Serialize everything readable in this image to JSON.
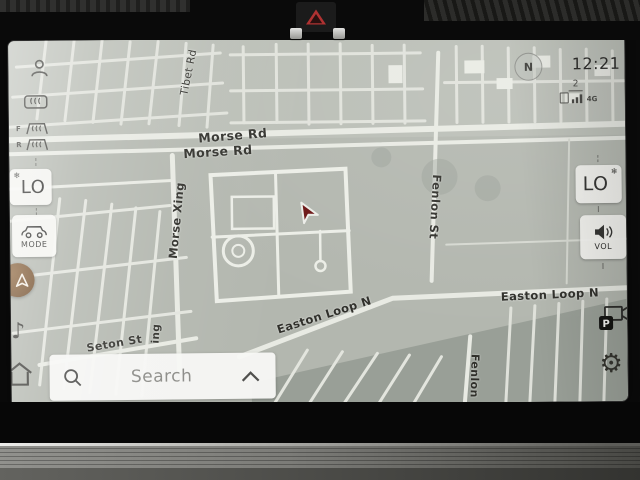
{
  "status": {
    "time": "12:21",
    "compass_n": "N",
    "profile": "2",
    "network": "4G"
  },
  "climate_left": {
    "lo": "LO",
    "defrost_front": "F",
    "defrost_rear": "R"
  },
  "climate_right": {
    "lo": "LO"
  },
  "mode": {
    "label": "MODE"
  },
  "volume": {
    "label": "VOL"
  },
  "search": {
    "placeholder": "Search"
  },
  "glyphs": {
    "snowflake": "❄",
    "music_note": "♪",
    "gear": "⚙",
    "parking": "P"
  },
  "colors": {
    "nav_accent": "#7a5530",
    "vehicle_arrow": "#6b1414",
    "hazard_red": "#b03232"
  },
  "map": {
    "labels": [
      {
        "id": "morse-rd-upper",
        "text": "Morse Rd"
      },
      {
        "id": "morse-rd-lower",
        "text": "Morse Rd"
      },
      {
        "id": "morse-xing",
        "text": "Morse Xing"
      },
      {
        "id": "tibet-rd",
        "text": "Tibet Rd"
      },
      {
        "id": "fenlon-st",
        "text": "Fenlon St"
      },
      {
        "id": "easton-loop-diagonal",
        "text": "Easton Loop N"
      },
      {
        "id": "easton-loop-right",
        "text": "Easton Loop N"
      },
      {
        "id": "seton-st",
        "text": "Seton St"
      },
      {
        "id": "morse-xing-partial",
        "text": "ing"
      },
      {
        "id": "fenlon-st-partial",
        "text": "Fenlon"
      }
    ]
  }
}
